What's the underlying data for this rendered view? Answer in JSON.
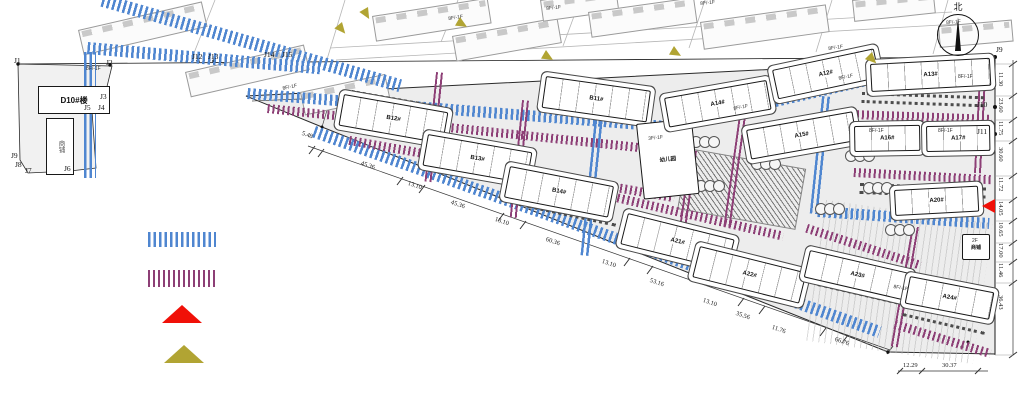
{
  "colors": {
    "road_blue": "#4f86d0",
    "road_purple": "#8d3f76",
    "red": "#f01008",
    "olive": "#b1a433",
    "site_fill": "#ededed"
  },
  "north": {
    "label": "北"
  },
  "buildings": [
    {
      "label": "D10#楼",
      "x": 38,
      "y": 86,
      "w": 70,
      "h": 26,
      "rot": 0,
      "cls": "main"
    },
    {
      "label": "商铺",
      "x": 46,
      "y": 118,
      "w": 26,
      "h": 55,
      "rot": 0,
      "cls": "annex"
    },
    {
      "label": "B12#",
      "x": 344,
      "y": 94,
      "w": 104,
      "h": 30,
      "rot": 10
    },
    {
      "label": "B13#",
      "x": 428,
      "y": 134,
      "w": 104,
      "h": 30,
      "rot": 10
    },
    {
      "label": "B11#",
      "x": 546,
      "y": 76,
      "w": 104,
      "h": 30,
      "rot": 8
    },
    {
      "label": "B14#",
      "x": 510,
      "y": 166,
      "w": 104,
      "h": 30,
      "rot": 11
    },
    {
      "label": "A21#",
      "x": 628,
      "y": 213,
      "w": 108,
      "h": 30,
      "rot": 14
    },
    {
      "label": "A22#",
      "x": 700,
      "y": 246,
      "w": 108,
      "h": 30,
      "rot": 14
    },
    {
      "label": "幼儿园",
      "x": 636,
      "y": 124,
      "w": 54,
      "h": 74,
      "rot": -6,
      "cls": "kg"
    },
    {
      "label": "A14#",
      "x": 664,
      "y": 98,
      "w": 102,
      "h": 28,
      "rot": -10
    },
    {
      "label": "A12#",
      "x": 772,
      "y": 70,
      "w": 102,
      "h": 28,
      "rot": -12
    },
    {
      "label": "A15#",
      "x": 746,
      "y": 130,
      "w": 106,
      "h": 28,
      "rot": -10
    },
    {
      "label": "A13#",
      "x": 870,
      "y": 64,
      "w": 118,
      "h": 26,
      "rot": -3
    },
    {
      "label": "A16#",
      "x": 854,
      "y": 126,
      "w": 64,
      "h": 24,
      "rot": -1
    },
    {
      "label": "A17#",
      "x": 926,
      "y": 126,
      "w": 62,
      "h": 24,
      "rot": -1
    },
    {
      "label": "A20#",
      "x": 894,
      "y": 190,
      "w": 82,
      "h": 24,
      "rot": -3
    },
    {
      "label": "A23#",
      "x": 810,
      "y": 250,
      "w": 102,
      "h": 26,
      "rot": 13
    },
    {
      "label": "A24#",
      "x": 910,
      "y": 276,
      "w": 84,
      "h": 26,
      "rot": 11
    },
    {
      "label": "商铺",
      "x": 962,
      "y": 234,
      "w": 26,
      "h": 24,
      "rot": 0,
      "cls": "small"
    }
  ],
  "context_buildings": [
    {
      "x": 78,
      "y": 30,
      "w": 125,
      "h": 24,
      "rot": -13
    },
    {
      "x": 185,
      "y": 72,
      "w": 120,
      "h": 24,
      "rot": -13
    },
    {
      "x": 300,
      "y": 92,
      "w": 85,
      "h": 22,
      "rot": -12
    },
    {
      "x": 372,
      "y": 16,
      "w": 115,
      "h": 24,
      "rot": -9
    },
    {
      "x": 452,
      "y": 36,
      "w": 105,
      "h": 24,
      "rot": -10
    },
    {
      "x": 540,
      "y": 0,
      "w": 75,
      "h": 20,
      "rot": -8
    },
    {
      "x": 588,
      "y": 12,
      "w": 105,
      "h": 24,
      "rot": -8
    },
    {
      "x": 700,
      "y": 22,
      "w": 125,
      "h": 26,
      "rot": -8
    },
    {
      "x": 852,
      "y": 0,
      "w": 80,
      "h": 20,
      "rot": -6
    },
    {
      "x": 938,
      "y": 26,
      "w": 72,
      "h": 20,
      "rot": -5
    }
  ],
  "roads_blue": [
    {
      "x": 104,
      "y": -6,
      "w": 310,
      "h": 13,
      "rot": 16
    },
    {
      "x": 84,
      "y": 52,
      "w": 12,
      "h": 126,
      "rot": 0
    },
    {
      "x": 88,
      "y": 42,
      "w": 235,
      "h": 12,
      "rot": 5
    },
    {
      "x": 248,
      "y": 88,
      "w": 445,
      "h": 11,
      "rot": 4.5
    },
    {
      "x": 688,
      "y": 116,
      "w": 190,
      "h": 11,
      "rot": -13
    },
    {
      "x": 598,
      "y": 88,
      "w": 10,
      "h": 168,
      "rot": 6
    },
    {
      "x": 316,
      "y": 126,
      "w": 600,
      "h": 12,
      "rot": 19.5
    },
    {
      "x": 818,
      "y": 206,
      "w": 172,
      "h": 11,
      "rot": 4
    },
    {
      "x": 822,
      "y": 96,
      "w": 10,
      "h": 118,
      "rot": 6
    }
  ],
  "roads_purple": [
    {
      "x": 268,
      "y": 104,
      "w": 420,
      "h": 9,
      "rot": 6
    },
    {
      "x": 350,
      "y": 136,
      "w": 330,
      "h": 9,
      "rot": 10
    },
    {
      "x": 436,
      "y": 72,
      "w": 9,
      "h": 110,
      "rot": 6
    },
    {
      "x": 522,
      "y": 100,
      "w": 9,
      "h": 118,
      "rot": 6
    },
    {
      "x": 740,
      "y": 108,
      "w": 9,
      "h": 120,
      "rot": 8
    },
    {
      "x": 850,
      "y": 58,
      "w": 145,
      "h": 9,
      "rot": 2
    },
    {
      "x": 852,
      "y": 110,
      "w": 140,
      "h": 9,
      "rot": 2
    },
    {
      "x": 854,
      "y": 168,
      "w": 138,
      "h": 9,
      "rot": 3
    },
    {
      "x": 912,
      "y": 226,
      "w": 9,
      "h": 122,
      "rot": 10
    },
    {
      "x": 808,
      "y": 224,
      "w": 120,
      "h": 9,
      "rot": 18
    },
    {
      "x": 896,
      "y": 320,
      "w": 100,
      "h": 9,
      "rot": 17
    },
    {
      "x": 858,
      "y": 256,
      "w": 125,
      "h": 9,
      "rot": 16
    },
    {
      "x": 690,
      "y": 150,
      "w": 9,
      "h": 90,
      "rot": 8
    },
    {
      "x": 560,
      "y": 180,
      "w": 230,
      "h": 9,
      "rot": 13
    },
    {
      "x": 980,
      "y": 58,
      "w": 9,
      "h": 115,
      "rot": 3
    }
  ],
  "parking": [
    {
      "x": 352,
      "y": 90,
      "w": 92,
      "rot": 10
    },
    {
      "x": 436,
      "y": 131,
      "w": 92,
      "rot": 10
    },
    {
      "x": 360,
      "y": 127,
      "w": 88,
      "rot": 10
    },
    {
      "x": 444,
      "y": 169,
      "w": 88,
      "rot": 10
    },
    {
      "x": 548,
      "y": 80,
      "w": 95,
      "rot": 8
    },
    {
      "x": 520,
      "y": 170,
      "w": 92,
      "rot": 10
    },
    {
      "x": 528,
      "y": 205,
      "w": 90,
      "rot": 12
    },
    {
      "x": 638,
      "y": 216,
      "w": 88,
      "rot": 14
    },
    {
      "x": 710,
      "y": 250,
      "w": 88,
      "rot": 14
    },
    {
      "x": 862,
      "y": 92,
      "w": 122,
      "rot": 2,
      "cls": "dbl"
    },
    {
      "x": 860,
      "y": 183,
      "w": 126,
      "rot": 2,
      "cls": "dbl"
    },
    {
      "x": 893,
      "y": 214,
      "w": 78,
      "rot": -3
    },
    {
      "x": 818,
      "y": 283,
      "w": 96,
      "rot": 13
    },
    {
      "x": 903,
      "y": 313,
      "w": 84,
      "rot": 13
    }
  ],
  "trees": [
    {
      "x": 693,
      "y": 136
    },
    {
      "x": 754,
      "y": 158
    },
    {
      "x": 698,
      "y": 180
    },
    {
      "x": 848,
      "y": 150
    },
    {
      "x": 866,
      "y": 182
    },
    {
      "x": 818,
      "y": 203
    },
    {
      "x": 888,
      "y": 224
    }
  ],
  "patches": [
    {
      "x": 688,
      "y": 148,
      "w": 118,
      "h": 60,
      "rot": 10,
      "cls": "hatch-dark"
    },
    {
      "x": 826,
      "y": 200,
      "w": 168,
      "h": 142,
      "rot": 8,
      "cls": "stripes-v"
    }
  ],
  "dims_bottom": [
    {
      "v": "5.48",
      "x": 303,
      "y": 130,
      "rot": 19
    },
    {
      "v": "45.36",
      "x": 362,
      "y": 160,
      "rot": 19
    },
    {
      "v": "13.10",
      "x": 409,
      "y": 180,
      "rot": 19
    },
    {
      "v": "45.36",
      "x": 452,
      "y": 199,
      "rot": 19
    },
    {
      "v": "13.10",
      "x": 496,
      "y": 216,
      "rot": 19
    },
    {
      "v": "60.36",
      "x": 547,
      "y": 236,
      "rot": 19
    },
    {
      "v": "13.10",
      "x": 603,
      "y": 258,
      "rot": 19
    },
    {
      "v": "53.16",
      "x": 651,
      "y": 277,
      "rot": 19
    },
    {
      "v": "13.10",
      "x": 704,
      "y": 297,
      "rot": 19
    },
    {
      "v": "35.56",
      "x": 737,
      "y": 310,
      "rot": 19
    },
    {
      "v": "11.76",
      "x": 773,
      "y": 324,
      "rot": 19
    },
    {
      "v": "66.76",
      "x": 836,
      "y": 336,
      "rot": 19
    }
  ],
  "dims_br": [
    {
      "v": "12.29",
      "x": 903,
      "y": 362,
      "rot": 0
    },
    {
      "v": "30.37",
      "x": 942,
      "y": 362,
      "rot": 0
    }
  ],
  "dims_right": [
    {
      "v": "11.30",
      "x": 1004,
      "y": 72,
      "rot": 90
    },
    {
      "v": "23.60",
      "x": 1004,
      "y": 98,
      "rot": 90
    },
    {
      "v": "11.75",
      "x": 1004,
      "y": 121,
      "rot": 90
    },
    {
      "v": "30.60",
      "x": 1004,
      "y": 147,
      "rot": 90
    },
    {
      "v": "11.72",
      "x": 1004,
      "y": 177,
      "rot": 90
    },
    {
      "v": "14.05",
      "x": 1004,
      "y": 201,
      "rot": 90
    },
    {
      "v": "10.65",
      "x": 1004,
      "y": 222,
      "rot": 90
    },
    {
      "v": "17.00",
      "x": 1004,
      "y": 243,
      "rot": 90
    },
    {
      "v": "11.46",
      "x": 1004,
      "y": 263,
      "rot": 90
    },
    {
      "v": "36.43",
      "x": 1004,
      "y": 295,
      "rot": 90
    }
  ],
  "points": [
    {
      "label": "J1",
      "x": 14,
      "y": 56
    },
    {
      "label": "J2",
      "x": 106,
      "y": 58
    },
    {
      "label": "J12",
      "x": 192,
      "y": 52
    },
    {
      "label": "J13",
      "x": 208,
      "y": 52
    },
    {
      "label": "J14",
      "x": 264,
      "y": 50
    },
    {
      "label": "J15",
      "x": 282,
      "y": 50
    },
    {
      "label": "J3",
      "x": 100,
      "y": 92
    },
    {
      "label": "J5",
      "x": 84,
      "y": 103
    },
    {
      "label": "J4",
      "x": 98,
      "y": 103
    },
    {
      "label": "J6",
      "x": 64,
      "y": 164
    },
    {
      "label": "J7",
      "x": 25,
      "y": 166
    },
    {
      "label": "J8",
      "x": 15,
      "y": 160
    },
    {
      "label": "J9",
      "x": 11,
      "y": 151
    },
    {
      "label": "J9",
      "x": 996,
      "y": 45
    },
    {
      "label": "J10",
      "x": 977,
      "y": 100
    },
    {
      "label": "J11",
      "x": 977,
      "y": 127
    }
  ],
  "floor_tags": [
    {
      "v": "8F/-1F",
      "x": 86,
      "y": 66,
      "rot": 0
    },
    {
      "v": "8F/-1F",
      "x": 282,
      "y": 86,
      "rot": -12
    },
    {
      "v": "8F/-1F",
      "x": 448,
      "y": 16,
      "rot": -8
    },
    {
      "v": "8F/-1F",
      "x": 546,
      "y": 6,
      "rot": -6
    },
    {
      "v": "8F/-1F",
      "x": 700,
      "y": 1,
      "rot": -6
    },
    {
      "v": "8F/-1F",
      "x": 828,
      "y": 46,
      "rot": -8
    },
    {
      "v": "8F/-1F",
      "x": 946,
      "y": 20,
      "rot": -4
    },
    {
      "v": "8F/-1F",
      "x": 958,
      "y": 74,
      "rot": 0
    },
    {
      "v": "8F/-1F",
      "x": 733,
      "y": 106,
      "rot": -10
    },
    {
      "v": "8F/-1F",
      "x": 838,
      "y": 76,
      "rot": -12
    },
    {
      "v": "3F/-1F",
      "x": 648,
      "y": 136,
      "rot": -6
    },
    {
      "v": "2F",
      "x": 972,
      "y": 238,
      "rot": 0
    },
    {
      "v": "8F/-1F",
      "x": 869,
      "y": 128,
      "rot": 0
    },
    {
      "v": "8F/-1F",
      "x": 938,
      "y": 128,
      "rot": 0
    },
    {
      "v": "8F/-1F",
      "x": 894,
      "y": 284,
      "rot": 10
    }
  ],
  "arrows": [
    {
      "x": 342,
      "y": 22,
      "rot": 50
    },
    {
      "x": 368,
      "y": 7,
      "rot": 60
    },
    {
      "x": 460,
      "y": 17,
      "rot": 30
    },
    {
      "x": 546,
      "y": 50,
      "rot": 30
    },
    {
      "x": 674,
      "y": 46,
      "rot": 30
    },
    {
      "x": 872,
      "y": 52,
      "rot": 45
    }
  ],
  "red_arrow": {
    "x": 982,
    "y": 199
  }
}
